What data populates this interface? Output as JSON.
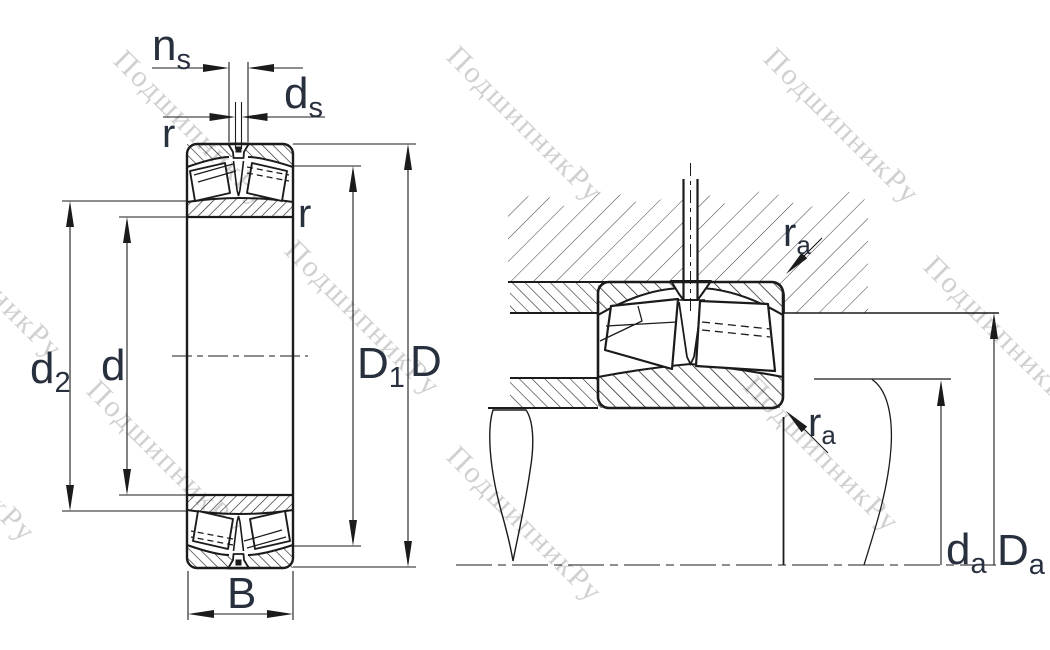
{
  "drawing": {
    "title": "spherical-roller-bearing-dimension-drawing",
    "watermark": {
      "text": "ПодшипникРу"
    },
    "labels": {
      "ns": {
        "base": "n",
        "sub": "s"
      },
      "ds": {
        "base": "d",
        "sub": "s"
      },
      "r": {
        "base": "r"
      },
      "d2": {
        "base": "d",
        "sub": "2"
      },
      "d": {
        "base": "d"
      },
      "D1": {
        "base": "D",
        "sub": "1"
      },
      "D": {
        "base": "D"
      },
      "B": {
        "base": "B"
      },
      "ra": {
        "base": "r",
        "sub": "a"
      },
      "da": {
        "base": "d",
        "sub": "a"
      },
      "Da": {
        "base": "D",
        "sub": "a"
      }
    },
    "colors": {
      "line": "#1b1b1b",
      "label": "#28303e",
      "watermark": "#c5c5c5",
      "background": "#ffffff"
    }
  }
}
